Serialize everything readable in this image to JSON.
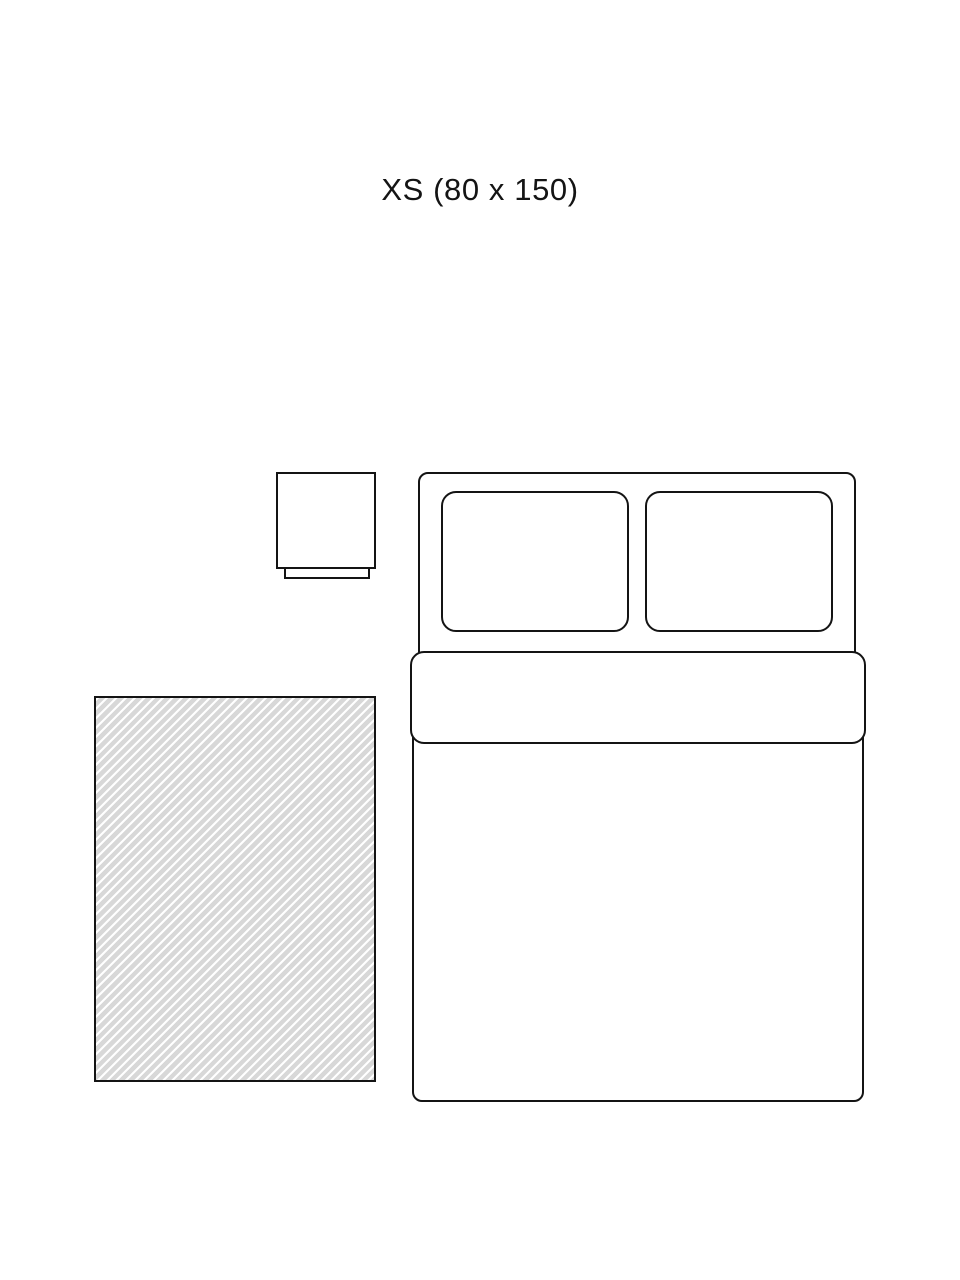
{
  "diagram": {
    "title": "XS (80 x 150)",
    "size_code": "XS",
    "dimensions": "80 x 150",
    "colors": {
      "background": "#ffffff",
      "outline": "#141414",
      "rug_stripe": "#d8d8d8"
    }
  }
}
